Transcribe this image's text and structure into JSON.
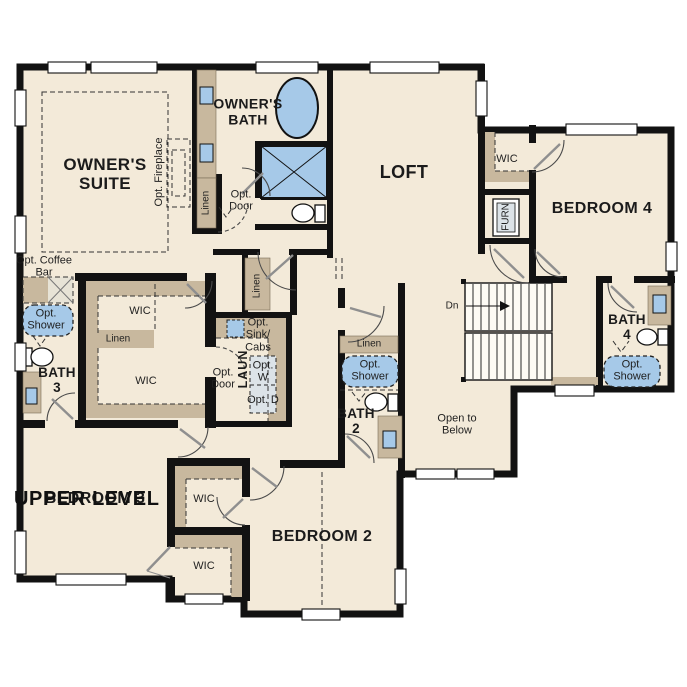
{
  "title": "UPPER LEVEL",
  "rooms": {
    "owners_suite": "OWNER'S SUITE",
    "owners_bath": "OWNER'S BATH",
    "loft": "LOFT",
    "bedroom2": "BEDROOM 2",
    "bedroom3": "BEDROOM 3",
    "bedroom4": "BEDROOM 4",
    "bath2": "BATH 2",
    "bath3": "BATH 3",
    "bath4": "BATH 4",
    "laundry": "LAUN",
    "open_to_below": "Open to Below"
  },
  "closets": {
    "wic": "WIC",
    "linen": "Linen"
  },
  "options": {
    "fireplace": "Opt. Fireplace",
    "coffee_bar": "Opt. Coffee Bar",
    "shower": "Opt. Shower",
    "door": "Opt. Door",
    "sink_cabs": "Opt. Sink/ Cabs",
    "washer": "Opt. W",
    "dryer": "Opt. D"
  },
  "equipment": {
    "furnace": "FURN"
  },
  "stairs": {
    "down": "Dn"
  },
  "colors": {
    "floor": "#f3ead9",
    "wall": "#121212",
    "fixture_blue": "#a6c9e8",
    "cabinet_tan": "#c8b89e",
    "appliance_gray": "#dce3e8"
  }
}
